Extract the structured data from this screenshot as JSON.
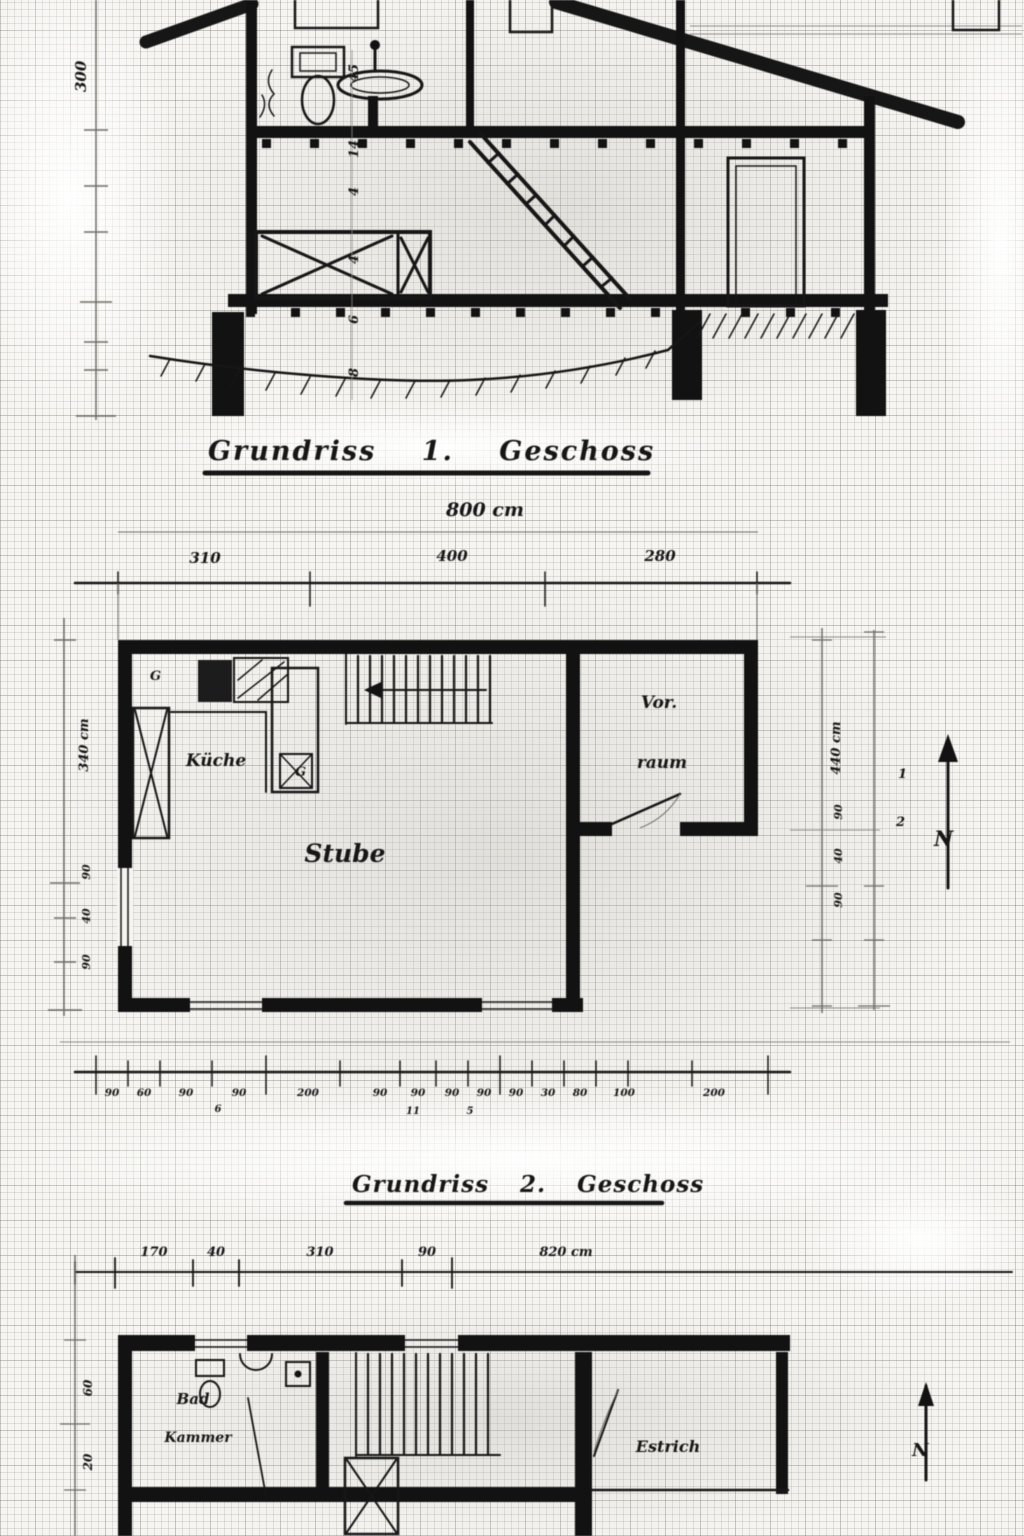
{
  "scan": {
    "section": {
      "left_dim_label": "300",
      "inner_dim_labels": [
        "45",
        "14",
        "4",
        "4",
        "6",
        "8"
      ]
    },
    "plan1": {
      "title": "Grundriss 1. Geschoss",
      "overall_width_label": "800 cm",
      "top_dims": [
        "310",
        "400",
        "280"
      ],
      "rooms": {
        "kitchen": "Küche",
        "living_room": "Stube",
        "hall_line1": "Vor.",
        "hall_line2": "raum"
      },
      "fixture_marks": [
        "G",
        "G"
      ],
      "left_dims": [
        "340 cm",
        "90",
        "40",
        "90"
      ],
      "right_dims": [
        "440 cm",
        "90",
        "40",
        "90"
      ],
      "right_marks": [
        "1",
        "2"
      ],
      "compass_label": "N",
      "bottom_dims": [
        "90",
        "60",
        "90",
        "90",
        "200",
        "90",
        "90",
        "90",
        "90",
        "90",
        "30",
        "80",
        "100",
        "200"
      ],
      "bottom_submarks": [
        "6",
        "11",
        "5"
      ]
    },
    "plan2": {
      "title": "Grundriss 2. Geschoss",
      "top_dims": [
        "170",
        "40",
        "310",
        "90",
        "820 cm"
      ],
      "rooms": {
        "bath_line1": "Bad",
        "bath_line2": "Kammer",
        "attic": "Estrich"
      },
      "left_dims": [
        "60",
        "20"
      ],
      "compass_label": "N"
    }
  }
}
